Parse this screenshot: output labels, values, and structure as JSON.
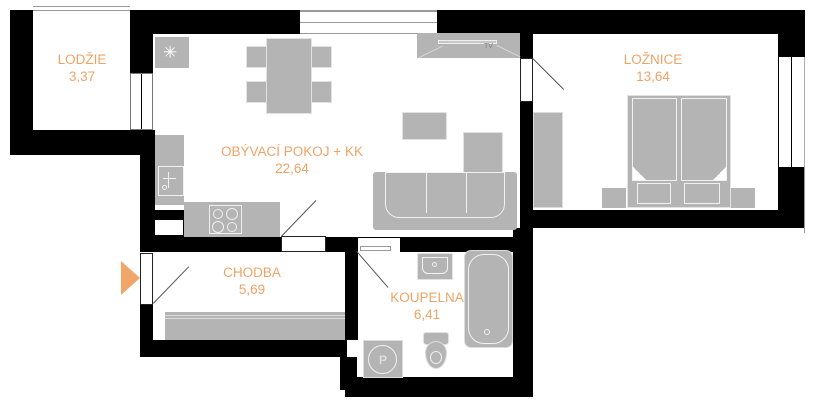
{
  "colors": {
    "bg": "#ffffff",
    "wall": "#000000",
    "furniture": "#b4b4b4",
    "furniture-line": "#e2e2e2",
    "label": "#efa466",
    "entrance": "#f0a668"
  },
  "rooms": [
    {
      "name": "LODŽIE",
      "area": "3,37"
    },
    {
      "name": "OBÝVACÍ POKOJ + KK",
      "area": "22,64"
    },
    {
      "name": "LOŽNICE",
      "area": "13,64"
    },
    {
      "name": "CHODBA",
      "area": "5,69"
    },
    {
      "name": "KOUPELNA",
      "area": "6,41"
    }
  ],
  "symbols": {
    "boiler": "✳",
    "washer": "P",
    "tv": "TV"
  }
}
